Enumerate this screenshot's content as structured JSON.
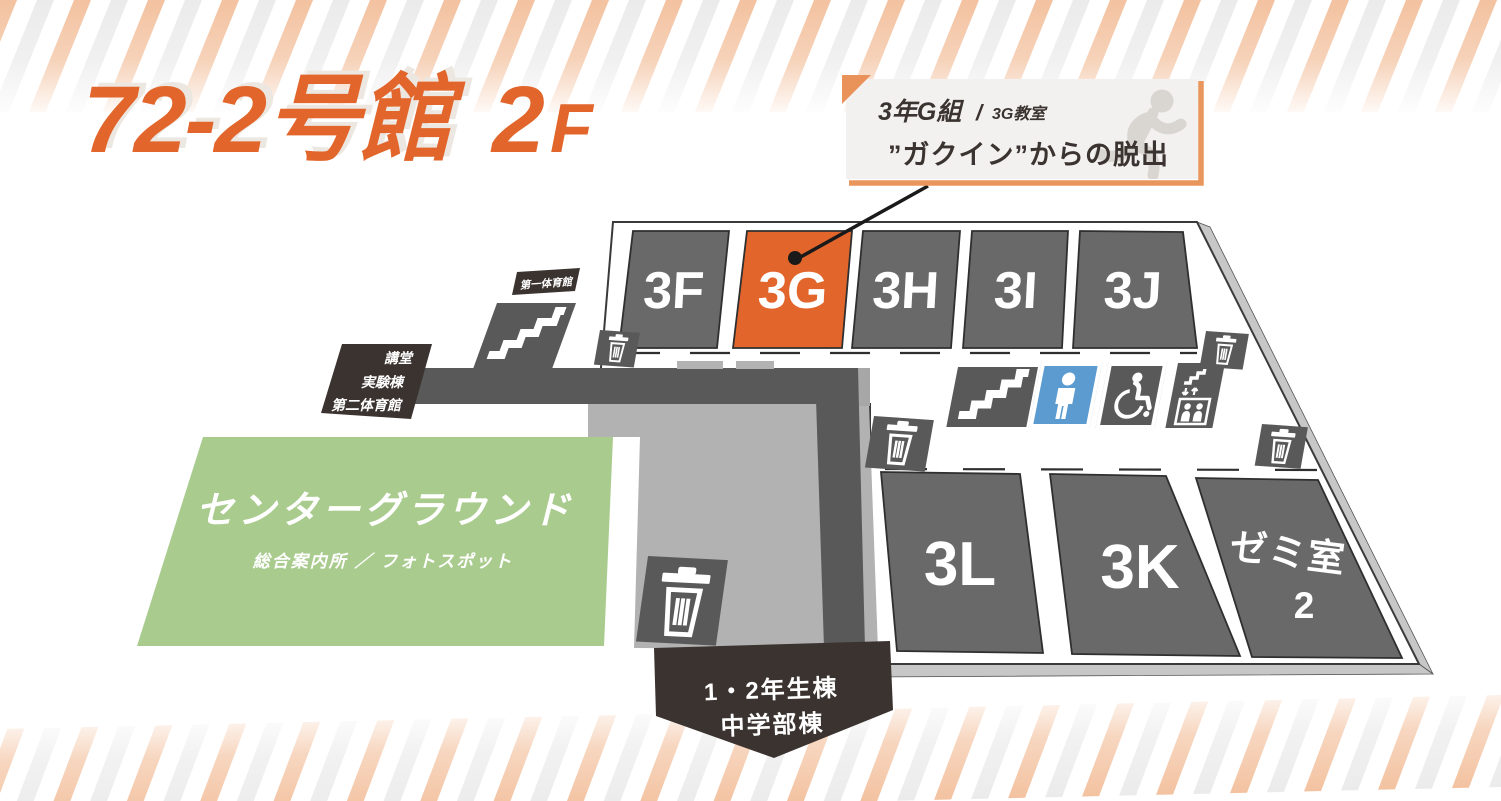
{
  "header": {
    "building": "72-2号館",
    "floor_number": "2",
    "floor_letter": "F"
  },
  "callout": {
    "class_name": "3年G組",
    "separator": "/",
    "room_name": "3G教室",
    "event_title": "”ガクイン”からの脱出"
  },
  "map": {
    "rooms_top": [
      "3F",
      "3G",
      "3H",
      "3I",
      "3J"
    ],
    "rooms_bottom": [
      "3L",
      "3K"
    ],
    "seminar_room": {
      "name": "ゼミ室",
      "number": "2"
    },
    "highlighted_room": "3G",
    "ground": {
      "title": "センターグラウンド",
      "subtitle": "総合案内所 ／ フォトスポット"
    },
    "exits": {
      "north": "第一体育館",
      "west": [
        "講堂",
        "実験棟",
        "第二体育館"
      ],
      "south": [
        "1・2年生棟",
        "中学部棟"
      ]
    },
    "icons": [
      "stairs-icon",
      "toilet-icon",
      "wheelchair-icon",
      "elevator-icon",
      "trash-icon",
      "running-man-icon"
    ]
  },
  "colors": {
    "accent_orange": "#E2662B",
    "stripe_orange": "#F3C2A0",
    "stripe_gray": "#EBEBEB",
    "room_gray": "#696969",
    "corridor_gray": "#595959",
    "walkway_gray": "#B2B2B2",
    "plate_edge_gray": "#C7C7C7",
    "ground_green": "#A9CB8E",
    "toilet_blue": "#5B9BD0",
    "label_dark": "#3B3330",
    "callout_bg": "#F2F1EF",
    "callout_border": "#E8965C"
  }
}
